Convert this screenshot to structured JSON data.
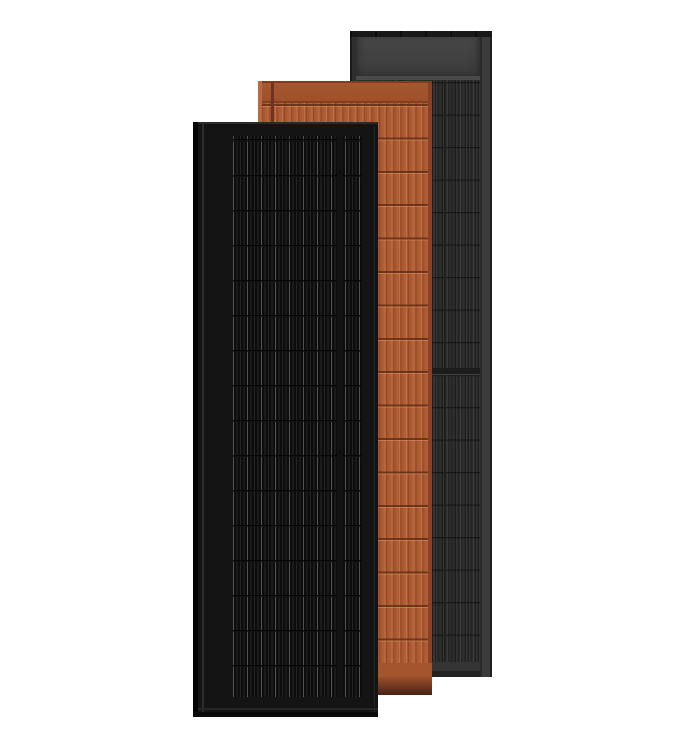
{
  "image": {
    "kind": "product-render",
    "subject": "Three overlapping rectangular solar panels on a white background",
    "background_color": "#ffffff",
    "panels": [
      {
        "name": "gray-solar-panel",
        "position": "back-right",
        "frame_color": "#3b3b3b",
        "header_color": "#414141",
        "cells_color": "#292929",
        "stripe_color": "#353535",
        "row_line_color": "#1c1c1c"
      },
      {
        "name": "terracotta-solar-panel",
        "position": "middle",
        "frame_color": "#8a4224",
        "header_color": "#a1532e",
        "cells_color": "#aa5931",
        "stripe_color": "#bf7046",
        "row_line_color": "#8a4323"
      },
      {
        "name": "black-solar-panel",
        "position": "front-left",
        "frame_color": "#050505",
        "header_color": "#141414",
        "cells_color": "#0d0d0d",
        "stripe_color": "#262626",
        "row_line_color": "#1e1e1e"
      }
    ]
  }
}
